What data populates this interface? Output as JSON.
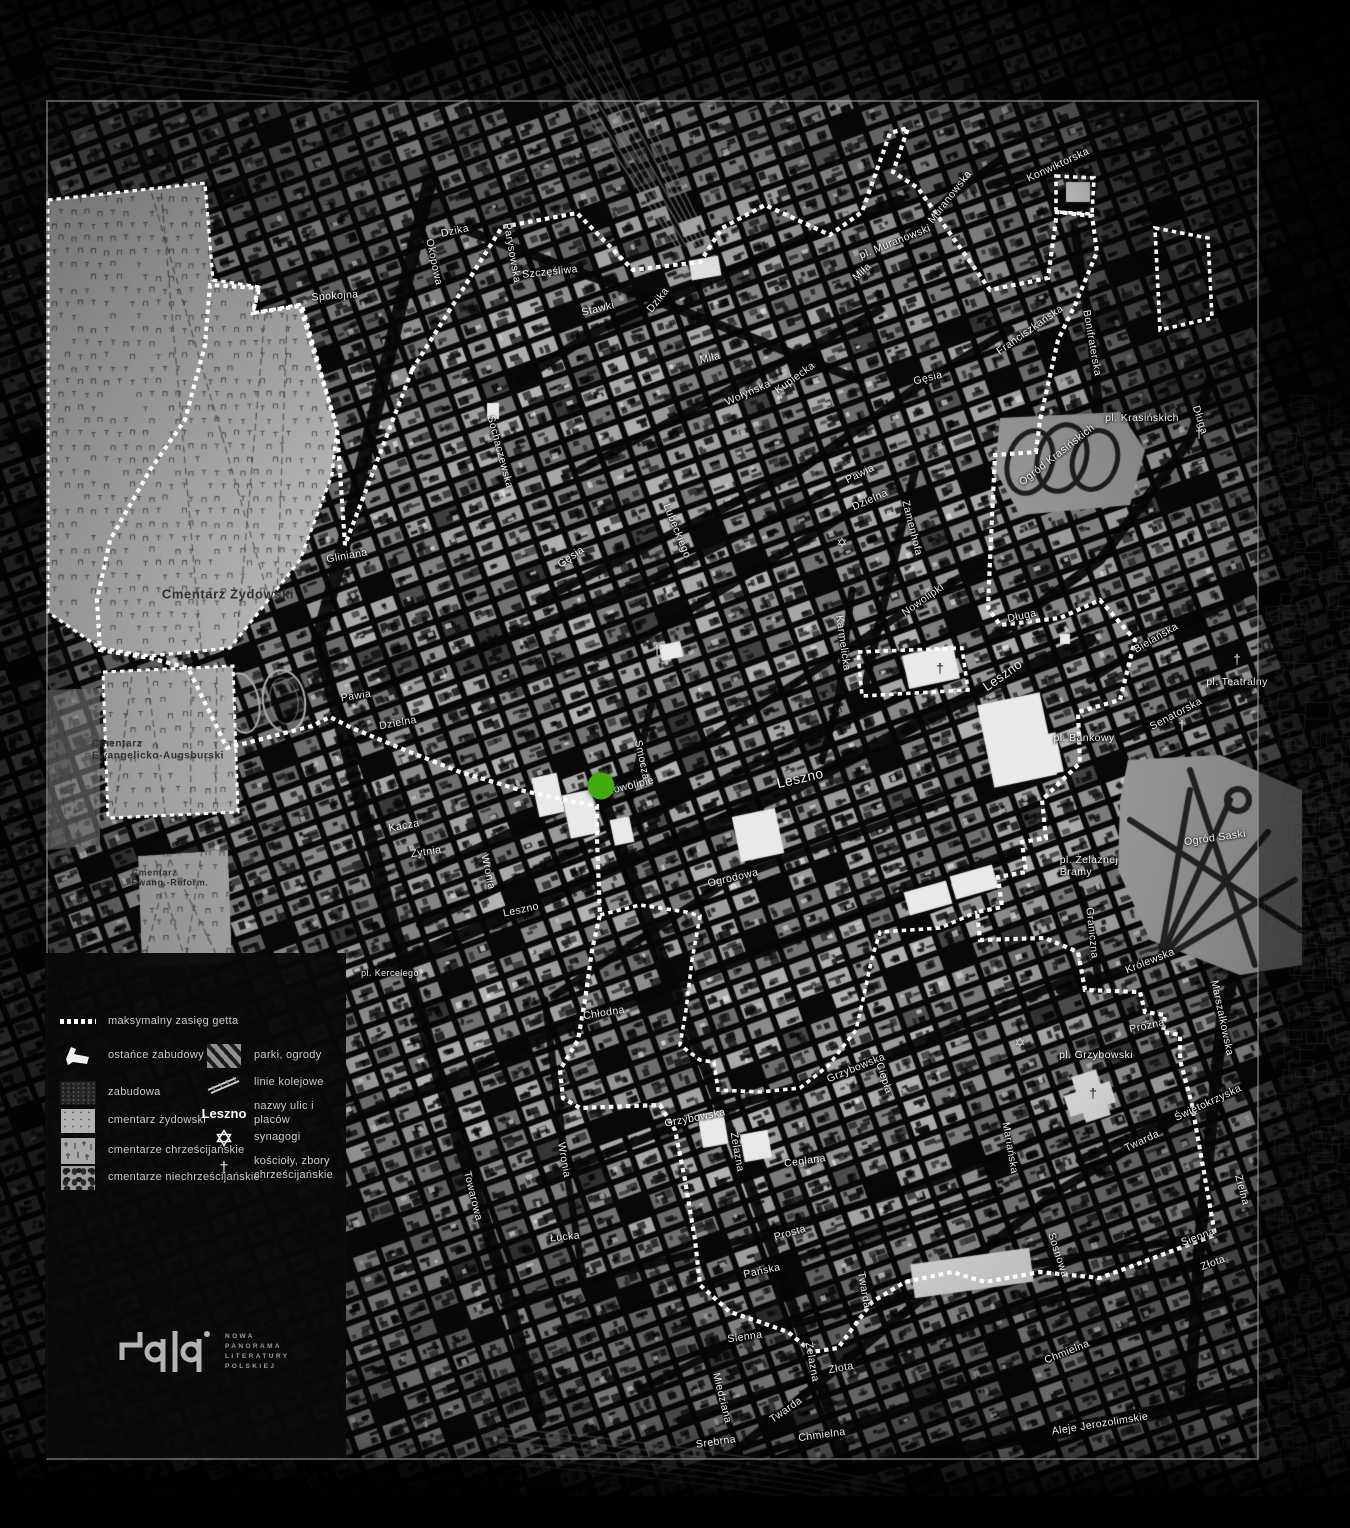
{
  "colors": {
    "background": "#070707",
    "boundary": "#ffffff",
    "marker_green": "#44ab0f",
    "frame_gray": "#9e9e9e",
    "cemetery_fill": "#b2b2b2"
  },
  "marker": {
    "name": "selected-location",
    "x": 601,
    "y": 786,
    "radius": 13.5,
    "color": "#44ab0f"
  },
  "legend": {
    "left": [
      {
        "id": "ghetto-boundary",
        "label": "maksymalny zasięg getta"
      },
      {
        "id": "building-remnants",
        "label": "ostańce zabudowy"
      },
      {
        "id": "built-up",
        "label": "zabudowa"
      },
      {
        "id": "jewish-cemetery",
        "label": "cmentarz żydowski"
      },
      {
        "id": "christian-cemeteries",
        "label": "cmentarze chrześcijańskie"
      },
      {
        "id": "non-christian-cemeteries",
        "label": "cmentarze niechrześcijańskie"
      }
    ],
    "right": [
      {
        "id": "parks",
        "label": "parki, ogrody"
      },
      {
        "id": "railways",
        "label": "linie kolejowe"
      },
      {
        "id": "street-name-sample",
        "label": "nazwy ulic i placów",
        "sample": "Leszno"
      },
      {
        "id": "synagogue",
        "label": "synagogi"
      },
      {
        "id": "church",
        "label": "kościoły, zbory\nchrześcijańskie"
      }
    ]
  },
  "logo": {
    "lines": [
      "NOWA",
      "PANORAMA",
      "LITERATURY",
      "POLSKIEJ"
    ]
  },
  "map_labels": [
    {
      "t": "Dzika",
      "x": 455,
      "y": 231,
      "r": -12
    },
    {
      "t": "Okopowa",
      "x": 434,
      "y": 262,
      "r": 78
    },
    {
      "t": "Spokojna",
      "x": 335,
      "y": 296,
      "r": -4
    },
    {
      "t": "Parysowska",
      "x": 512,
      "y": 253,
      "r": 80
    },
    {
      "t": "Szczęśliwa",
      "x": 550,
      "y": 272,
      "r": -6
    },
    {
      "t": "Stawki",
      "x": 598,
      "y": 309,
      "r": -14
    },
    {
      "t": "Dzika",
      "x": 658,
      "y": 300,
      "r": -52
    },
    {
      "t": "Miła",
      "x": 710,
      "y": 358,
      "r": -13
    },
    {
      "t": "Miła",
      "x": 862,
      "y": 272,
      "r": -42
    },
    {
      "t": "Wołyńska",
      "x": 748,
      "y": 393,
      "r": -24
    },
    {
      "t": "Kupiecka",
      "x": 795,
      "y": 378,
      "r": -36
    },
    {
      "t": "Gęsia",
      "x": 928,
      "y": 378,
      "r": -14
    },
    {
      "t": "Gęsia",
      "x": 571,
      "y": 557,
      "r": -35
    },
    {
      "t": "Pawia",
      "x": 860,
      "y": 474,
      "r": -26
    },
    {
      "t": "Dzielna",
      "x": 870,
      "y": 500,
      "r": -24
    },
    {
      "t": "Zamenhofa",
      "x": 912,
      "y": 528,
      "r": 76
    },
    {
      "t": "Lubeckiego",
      "x": 677,
      "y": 531,
      "r": 68
    },
    {
      "t": "Gliniana",
      "x": 347,
      "y": 556,
      "r": -10
    },
    {
      "t": "Sochaczewska",
      "x": 500,
      "y": 452,
      "r": 75
    },
    {
      "t": "Pawia",
      "x": 356,
      "y": 696,
      "r": -8
    },
    {
      "t": "Dzielna",
      "x": 398,
      "y": 723,
      "r": -10
    },
    {
      "t": "Kacza",
      "x": 404,
      "y": 826,
      "r": -10
    },
    {
      "t": "Żytnia",
      "x": 426,
      "y": 852,
      "r": -8
    },
    {
      "t": "Wronia",
      "x": 488,
      "y": 872,
      "r": 78
    },
    {
      "t": "Leszno",
      "x": 521,
      "y": 910,
      "r": -12
    },
    {
      "t": "Smocza",
      "x": 642,
      "y": 760,
      "r": 78
    },
    {
      "t": "Nowolipie",
      "x": 630,
      "y": 786,
      "r": -14
    },
    {
      "t": "Nowolipki",
      "x": 923,
      "y": 600,
      "r": -35
    },
    {
      "t": "Karmelicka",
      "x": 843,
      "y": 643,
      "r": 82
    },
    {
      "t": "Leszno",
      "x": 800,
      "y": 778,
      "r": -13,
      "s": 14
    },
    {
      "t": "Leszno",
      "x": 1003,
      "y": 676,
      "r": -35,
      "s": 13
    },
    {
      "t": "Ogrodowa",
      "x": 733,
      "y": 878,
      "r": -13
    },
    {
      "t": "pl. Kercelego",
      "x": 390,
      "y": 973,
      "r": 0,
      "s": 9
    },
    {
      "t": "Chłodna",
      "x": 604,
      "y": 1013,
      "r": -9
    },
    {
      "t": "Żelazna",
      "x": 737,
      "y": 1152,
      "r": 80
    },
    {
      "t": "Grzybowska",
      "x": 695,
      "y": 1118,
      "r": -11
    },
    {
      "t": "Grzybowska",
      "x": 856,
      "y": 1068,
      "r": -22
    },
    {
      "t": "Ciepła",
      "x": 884,
      "y": 1078,
      "r": 72
    },
    {
      "t": "Ceglana",
      "x": 805,
      "y": 1161,
      "r": -8
    },
    {
      "t": "Wronia",
      "x": 564,
      "y": 1160,
      "r": 80
    },
    {
      "t": "Towarowa",
      "x": 473,
      "y": 1196,
      "r": 76
    },
    {
      "t": "Łucka",
      "x": 565,
      "y": 1237,
      "r": -6
    },
    {
      "t": "Prosta",
      "x": 790,
      "y": 1233,
      "r": -16
    },
    {
      "t": "Pańska",
      "x": 762,
      "y": 1271,
      "r": -12
    },
    {
      "t": "Sienna",
      "x": 745,
      "y": 1337,
      "r": -8
    },
    {
      "t": "Sienna",
      "x": 1198,
      "y": 1237,
      "r": -20
    },
    {
      "t": "Złota",
      "x": 841,
      "y": 1368,
      "r": -10
    },
    {
      "t": "Złota",
      "x": 1213,
      "y": 1263,
      "r": -20
    },
    {
      "t": "Żelazna",
      "x": 812,
      "y": 1362,
      "r": 80
    },
    {
      "t": "Twarda",
      "x": 786,
      "y": 1410,
      "r": -35
    },
    {
      "t": "Twarda",
      "x": 864,
      "y": 1290,
      "r": 80
    },
    {
      "t": "Twarda",
      "x": 1142,
      "y": 1141,
      "r": -25
    },
    {
      "t": "Chmielna",
      "x": 822,
      "y": 1435,
      "r": -8
    },
    {
      "t": "Chmielna",
      "x": 1067,
      "y": 1352,
      "r": -22
    },
    {
      "t": "Srebrna",
      "x": 716,
      "y": 1442,
      "r": -8
    },
    {
      "t": "Miedziana",
      "x": 722,
      "y": 1398,
      "r": 76
    },
    {
      "t": "Sosnowa",
      "x": 1058,
      "y": 1255,
      "r": 72
    },
    {
      "t": "Aleje Jerozolimskie",
      "x": 1100,
      "y": 1424,
      "r": -9
    },
    {
      "t": "Marszałkowska",
      "x": 1222,
      "y": 1018,
      "r": 78
    },
    {
      "t": "Królewska",
      "x": 1150,
      "y": 961,
      "r": -22
    },
    {
      "t": "Graniczna",
      "x": 1092,
      "y": 933,
      "r": 84
    },
    {
      "t": "Próżna",
      "x": 1147,
      "y": 1026,
      "r": -12
    },
    {
      "t": "pl. Grzybowski",
      "x": 1096,
      "y": 1055,
      "r": 0
    },
    {
      "t": "Świętokrzyska",
      "x": 1208,
      "y": 1103,
      "r": -25
    },
    {
      "t": "Mariańska",
      "x": 1010,
      "y": 1148,
      "r": 80
    },
    {
      "t": "Zielna",
      "x": 1242,
      "y": 1190,
      "r": 75
    },
    {
      "t": "pl. Bankowy",
      "x": 1084,
      "y": 738,
      "r": 0
    },
    {
      "t": "pl. Żelaznej\nBramy",
      "x": 1089,
      "y": 866,
      "r": 0,
      "a": "left"
    },
    {
      "t": "Ogród Saski",
      "x": 1215,
      "y": 838,
      "r": -8
    },
    {
      "t": "Senatorska",
      "x": 1176,
      "y": 714,
      "r": -28
    },
    {
      "t": "pl. Teatralny",
      "x": 1237,
      "y": 682,
      "r": 0
    },
    {
      "t": "Bielańska",
      "x": 1156,
      "y": 638,
      "r": -30
    },
    {
      "t": "Długa",
      "x": 1022,
      "y": 616,
      "r": -12
    },
    {
      "t": "Długa",
      "x": 1200,
      "y": 420,
      "r": 72
    },
    {
      "t": "pl. Krasińskich",
      "x": 1142,
      "y": 418,
      "r": 0
    },
    {
      "t": "Ogród Krasińskich",
      "x": 1057,
      "y": 455,
      "r": -38
    },
    {
      "t": "Bonifraterska",
      "x": 1092,
      "y": 343,
      "r": 80
    },
    {
      "t": "Franciszkańska",
      "x": 1030,
      "y": 330,
      "r": -35
    },
    {
      "t": "Konwiktorska",
      "x": 1058,
      "y": 165,
      "r": -25
    },
    {
      "t": "Muranowska",
      "x": 950,
      "y": 197,
      "r": -52
    },
    {
      "t": "pl. Muranowski",
      "x": 895,
      "y": 242,
      "r": -22
    },
    {
      "t": "Cmentarz Żydowski",
      "x": 228,
      "y": 595,
      "r": 0,
      "s": 13,
      "c": "dark"
    },
    {
      "t": "Cmentarz\nEwangelicko-Augsburski",
      "x": 158,
      "y": 750,
      "r": 0,
      "s": 10,
      "c": "dark",
      "a": "left"
    },
    {
      "t": "Cmentarz\nEwang.-Reform.",
      "x": 170,
      "y": 878,
      "r": 0,
      "s": 9,
      "c": "dark",
      "a": "left"
    }
  ],
  "symbols": {
    "synagogues": [
      {
        "x": 842,
        "y": 543
      },
      {
        "x": 1020,
        "y": 1043
      }
    ],
    "churches": [
      {
        "x": 657,
        "y": 650
      },
      {
        "x": 940,
        "y": 668,
        "dark": 1
      },
      {
        "x": 1199,
        "y": 433
      },
      {
        "x": 1237,
        "y": 659
      },
      {
        "x": 1182,
        "y": 725
      },
      {
        "x": 1093,
        "y": 1093,
        "dark": 1
      }
    ]
  }
}
